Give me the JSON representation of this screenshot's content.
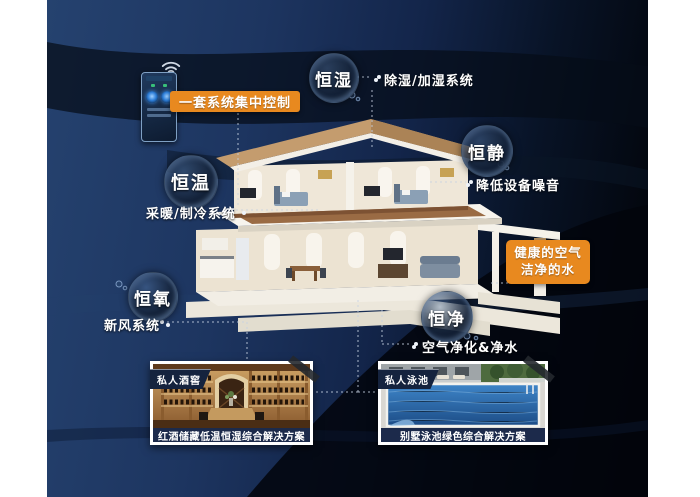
{
  "colors": {
    "accent_orange": "#e8891f",
    "background_navy": "#1d3560",
    "background_black": "#02050a",
    "caption_navy": "#1c2a4b",
    "text_white": "#ffffff"
  },
  "icons": {
    "wifi": "wifi-icon",
    "control_knob": "control-knob-icon",
    "bullet": "bullet-dot-icon"
  },
  "control_panel": {
    "box_label": "一套系统集中控制"
  },
  "pillars": [
    {
      "label": "恒湿",
      "callout": "除湿/加湿系统"
    },
    {
      "label": "恒静",
      "callout": "降低设备噪音"
    },
    {
      "label": "恒温",
      "callout": "采暖/制冷系统"
    },
    {
      "label": "恒氧",
      "callout": "新风系统"
    },
    {
      "label": "恒净",
      "callout": "空气净化&净水"
    }
  ],
  "highlight_box": {
    "line1": "健康的空气",
    "line2": "洁净的水"
  },
  "photos": [
    {
      "badge": "私人酒窖",
      "caption": "红酒储藏低温恒湿综合解决方案"
    },
    {
      "badge": "私人泳池",
      "caption": "别墅泳池绿色综合解决方案"
    }
  ]
}
